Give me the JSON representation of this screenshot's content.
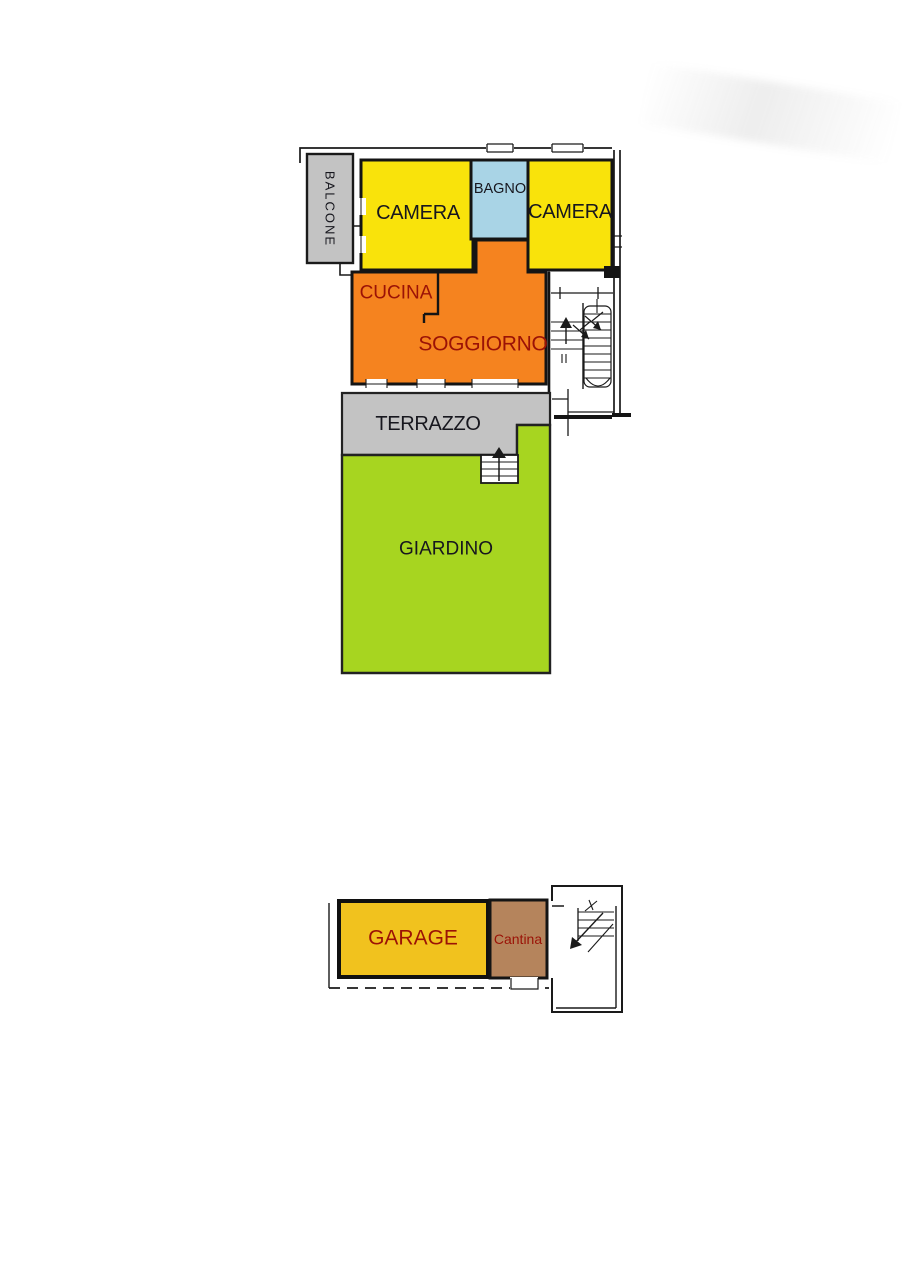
{
  "document": {
    "type": "floor-plan",
    "language": "it"
  },
  "palette": {
    "wall": "#141414",
    "label_dark": "#17171e",
    "label_red": "#9b1206",
    "background": "#ffffff",
    "terrace_gray": "#c3c3c3",
    "room_yellow": "#f9e30b",
    "bath_blue": "#a9d4e6",
    "living_orange": "#f5831f",
    "garden_green": "#a7d520",
    "garage_gold": "#f1c21e",
    "cellar_brown": "#b5845c"
  },
  "rooms": {
    "balcone": {
      "label": "BALCONE",
      "color": "#c3c3c3"
    },
    "camera_left": {
      "label": "CAMERA",
      "color": "#f9e30b"
    },
    "bagno": {
      "label": "BAGNO",
      "color": "#a9d4e6"
    },
    "camera_right": {
      "label": "CAMERA",
      "color": "#f9e30b"
    },
    "cucina": {
      "label": "CUCINA",
      "color": "#f5831f"
    },
    "soggiorno": {
      "label": "SOGGIORNO",
      "color": "#f5831f"
    },
    "terrazzo": {
      "label": "TERRAZZO",
      "color": "#c3c3c3"
    },
    "giardino": {
      "label": "GIARDINO",
      "color": "#a7d520"
    },
    "garage": {
      "label": "GARAGE",
      "color": "#f1c21e"
    },
    "cantina": {
      "label": "Cantina",
      "color": "#b5845c"
    }
  }
}
